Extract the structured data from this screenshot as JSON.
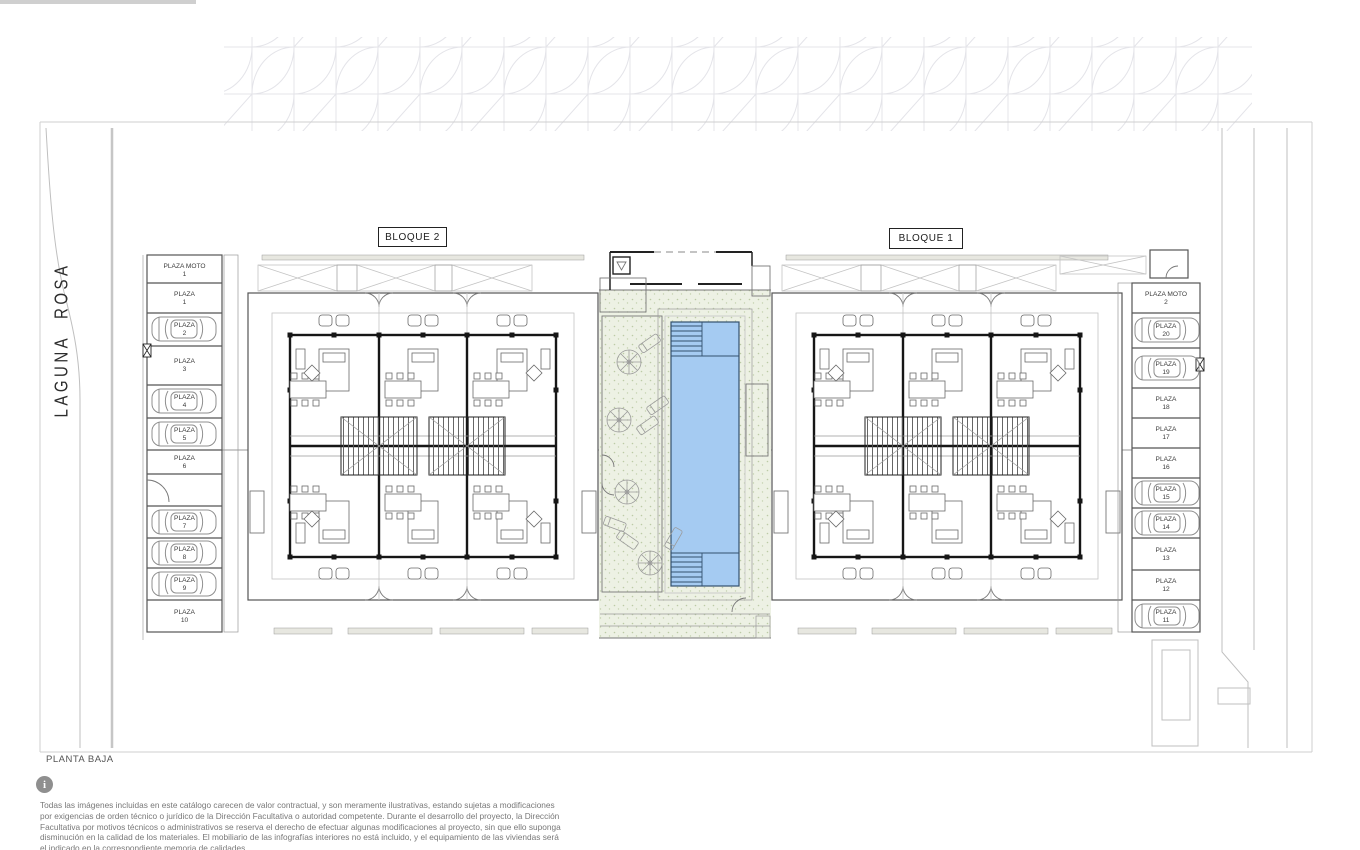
{
  "plan": {
    "floor_label": "PLANTA BAJA",
    "blocks": [
      {
        "label": "BLOQUE 2"
      },
      {
        "label": "BLOQUE 1"
      }
    ]
  },
  "street": {
    "name": "LAGUNA ROSA"
  },
  "parking_left": {
    "slots": [
      {
        "name": "PLAZA MOTO",
        "number": "1",
        "car": false
      },
      {
        "name": "PLAZA",
        "number": "1",
        "car": false
      },
      {
        "name": "PLAZA",
        "number": "2",
        "car": true
      },
      {
        "name": "PLAZA",
        "number": "3",
        "car": false
      },
      {
        "name": "PLAZA",
        "number": "4",
        "car": true
      },
      {
        "name": "PLAZA",
        "number": "5",
        "car": true
      },
      {
        "name": "PLAZA",
        "number": "6",
        "car": false
      },
      {
        "name": "PLAZA",
        "number": "7",
        "car": true
      },
      {
        "name": "PLAZA",
        "number": "8",
        "car": true
      },
      {
        "name": "PLAZA",
        "number": "9",
        "car": true
      },
      {
        "name": "PLAZA",
        "number": "10",
        "car": false
      }
    ]
  },
  "parking_right": {
    "slots": [
      {
        "name": "PLAZA MOTO",
        "number": "2",
        "car": false
      },
      {
        "name": "PLAZA",
        "number": "20",
        "car": true
      },
      {
        "name": "PLAZA",
        "number": "19",
        "car": true
      },
      {
        "name": "PLAZA",
        "number": "18",
        "car": false
      },
      {
        "name": "PLAZA",
        "number": "17",
        "car": false
      },
      {
        "name": "PLAZA",
        "number": "16",
        "car": false
      },
      {
        "name": "PLAZA",
        "number": "15",
        "car": true
      },
      {
        "name": "PLAZA",
        "number": "14",
        "car": true
      },
      {
        "name": "PLAZA",
        "number": "13",
        "car": false
      },
      {
        "name": "PLAZA",
        "number": "12",
        "car": false
      },
      {
        "name": "PLAZA",
        "number": "11",
        "car": true
      }
    ]
  },
  "footer": {
    "info_icon": "i",
    "disclaimer": "Todas las imágenes incluidas en este catálogo carecen de valor contractual, y son meramente ilustrativas, estando sujetas a modificaciones por exigencias de orden técnico o jurídico de la Dirección Facultativa o autoridad competente. Durante el desarrollo del proyecto, la Dirección Facultativa por motivos técnicos o administrativos se reserva el derecho de efectuar algunas modificaciones al proyecto, sin que ello suponga disminución en la calidad de los materiales. El mobiliario de las infografías interiores no está incluido, y el equipamiento de las viviendas será el indicado en la correspondiente memoria de calidades."
  },
  "colors": {
    "pool_blue": "#a5cbf2",
    "deck_green": "#edf1e4",
    "wall_dark": "#161616",
    "line_gray": "#cfcfcf"
  }
}
